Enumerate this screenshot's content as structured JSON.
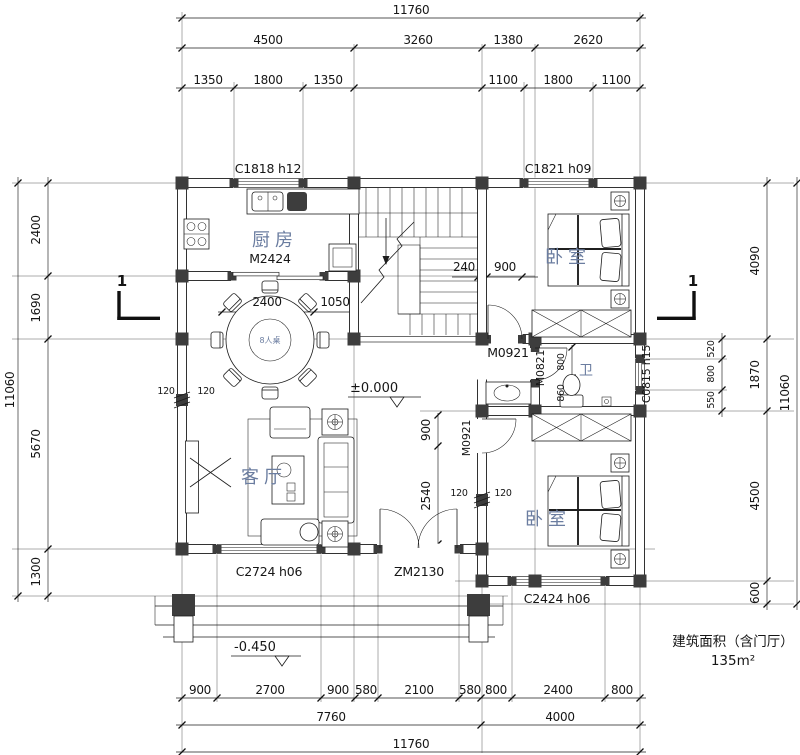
{
  "plan": {
    "area_note_line1": "建筑面积（含门厅）",
    "area_note_line2": "135m²"
  },
  "rooms": {
    "kitchen": "厨房",
    "bedroom_top": "卧室",
    "bedroom_bottom": "卧室",
    "living": "客厅",
    "bath": "卫",
    "dining_table": "8人桌"
  },
  "openings": {
    "c1818": "C1818 h12",
    "c1821": "C1821 h09",
    "c0815": "C0815 h15",
    "c2724": "C2724 h06",
    "c2424": "C2424 h06",
    "m2424": "M2424",
    "m0921_bed_top": "M0921",
    "m0921_bed_bottom": "M0921",
    "m0821": "M0821",
    "zm2130": "ZM2130"
  },
  "levels": {
    "ground": "±0.000",
    "porch": "-0.450"
  },
  "section_marks": {
    "left": "1",
    "right": "1"
  },
  "dims": {
    "top": {
      "total": "11760",
      "row2": [
        "4500",
        "3260",
        "1380",
        "2620"
      ],
      "row3": [
        "1350",
        "1800",
        "1350",
        "1100",
        "1800",
        "1100"
      ]
    },
    "bottom": {
      "row1": [
        "900",
        "2700",
        "900",
        "580",
        "2100",
        "580",
        "800",
        "2400",
        "800"
      ],
      "row2": [
        "7760",
        "4000"
      ],
      "total": "11760"
    },
    "left": {
      "outer": "11060",
      "inner": [
        "2400",
        "1690",
        "5670",
        "1300"
      ]
    },
    "right": {
      "outer": "11060",
      "inner": [
        "4090",
        "1870",
        "4500",
        "600"
      ],
      "window": [
        "520",
        "800",
        "550"
      ]
    },
    "interior": {
      "stair_240": "240",
      "bed_top_door_900": "900",
      "dining_2400": "2400",
      "dining_1050": "1050",
      "wall_left_120a": "120",
      "wall_left_120b": "120",
      "wall_mid_120a": "120",
      "wall_mid_120b": "120",
      "foyer_900": "900",
      "foyer_2540": "2540",
      "bath_800": "800",
      "bath_860": "860"
    }
  }
}
